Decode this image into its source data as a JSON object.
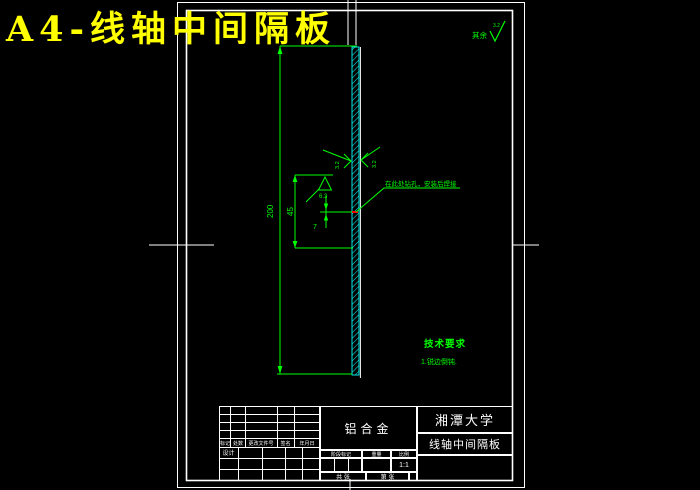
{
  "page_title": "A4-线轴中间隔板",
  "colors": {
    "background": "#000000",
    "sheet_line": "#ffffff",
    "annotation_green": "#00ff00",
    "part_cyan": "#00ffff",
    "title_yellow": "#ffff00",
    "marker_red": "#ff0000"
  },
  "annotations": {
    "surplus_label": "其余",
    "surplus_value": "3.2",
    "rough_left": "3.2",
    "rough_right": "3.2",
    "rough_triangle": "6.3",
    "dim_height": "200",
    "dim_inner": "45",
    "dim_small": "7",
    "leader_note": "在此处钻孔，安装后焊接",
    "tech_title": "技术要求",
    "tech_item_1": "1.锐边倒钝."
  },
  "titleblock": {
    "material": "铝合金",
    "org": "湘潭大学",
    "part": "线轴中间隔板",
    "rev_headers": [
      "标记",
      "处数",
      "更改文件号",
      "签名",
      "年月日"
    ],
    "designer_label": "设计",
    "mid_headers": [
      "阶段标记",
      "重量",
      "比例"
    ],
    "scale": "1:1",
    "sheet_total": "共 张",
    "sheet_no": "第 张"
  }
}
